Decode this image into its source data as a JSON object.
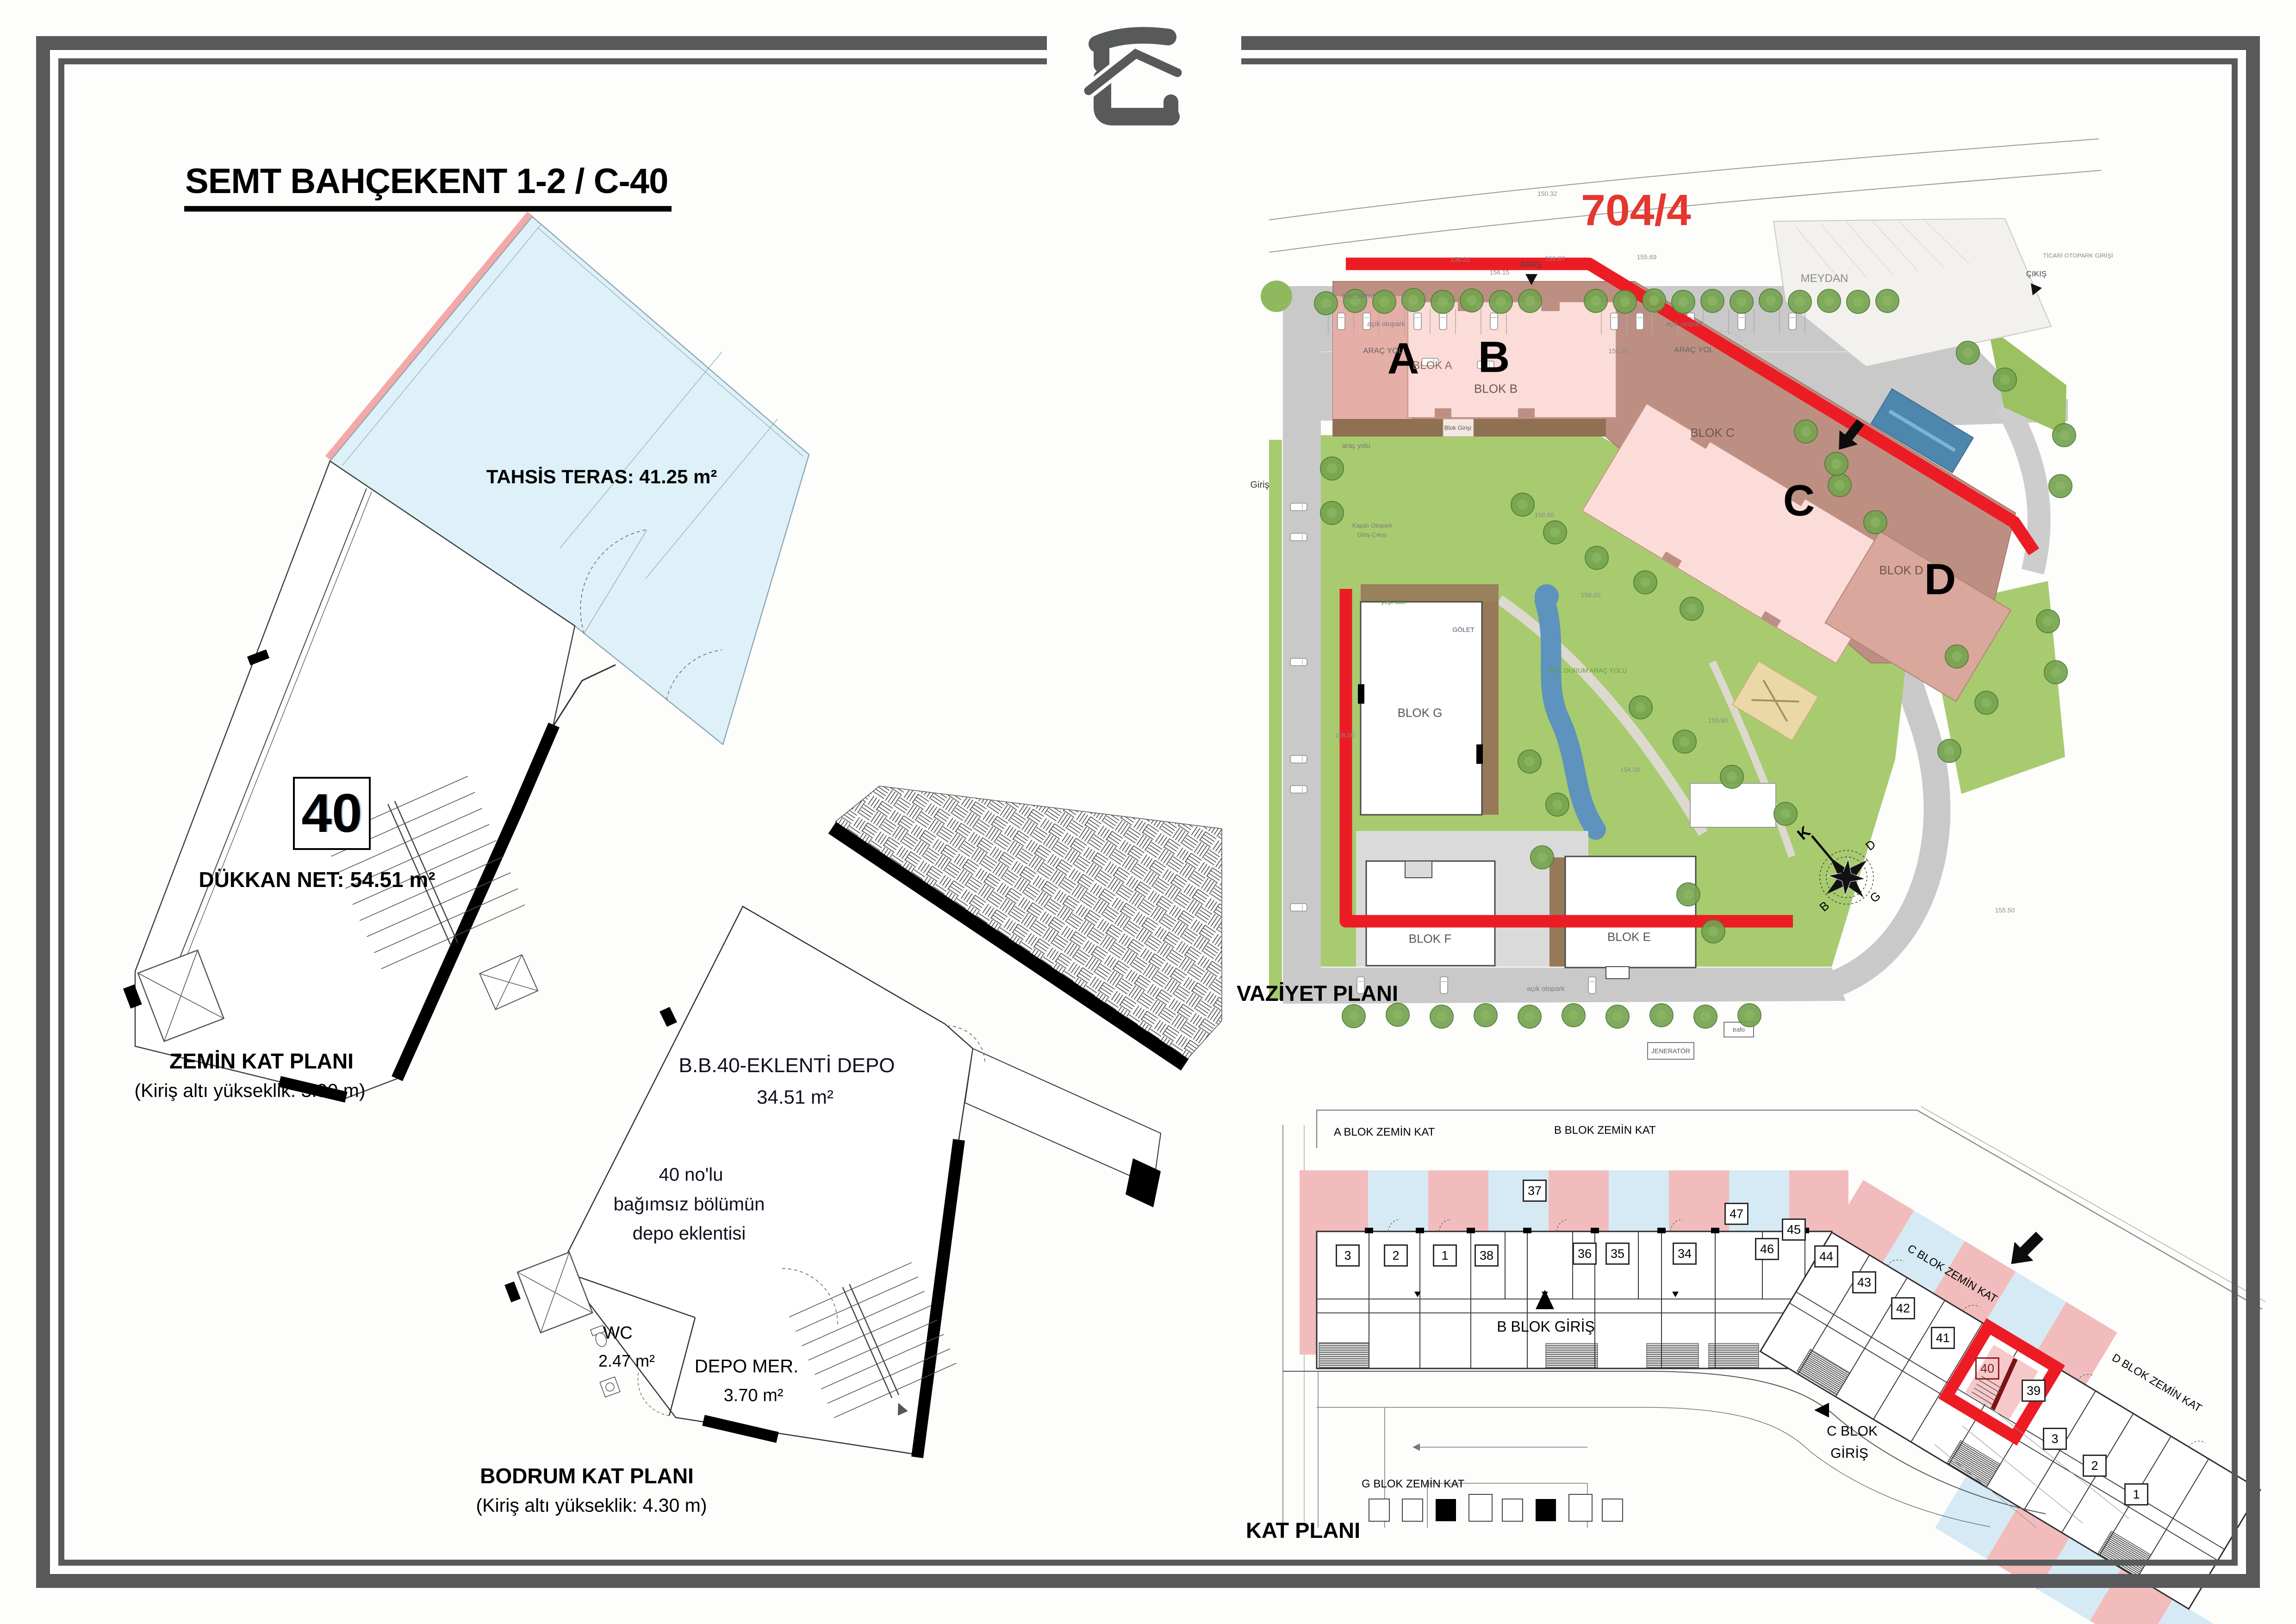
{
  "page": {
    "title": "SEMT BAHÇEKENT 1-2 / C-40"
  },
  "ground_floor_plan": {
    "terrace_label": "TAHSİS TERAS: 41.25 m²",
    "unit_number": "40",
    "shop_net_label": "DÜKKAN NET: 54.51 m²",
    "plan_name": "ZEMİN KAT PLANI",
    "height_note": "(Kiriş altı yükseklik: 3.90 m)"
  },
  "basement_plan": {
    "storage_name": "B.B.40-EKLENTİ DEPO",
    "storage_area": "34.51 m²",
    "annex_note_line1": "40 no'lu",
    "annex_note_line2": "bağımsız bölümün",
    "annex_note_line3": "depo eklentisi",
    "wc_label": "WC",
    "wc_area": "2.47 m²",
    "storage_stairs_label": "DEPO MER.",
    "storage_stairs_area": "3.70 m²",
    "plan_name": "BODRUM KAT PLANI",
    "height_note": "(Kiriş altı yükseklik: 4.30 m)"
  },
  "site_plan": {
    "plan_name": "VAZİYET PLANI",
    "parcel_number": "704/4",
    "block_letter_a": "A",
    "block_letter_b": "B",
    "block_letter_c": "C",
    "block_letter_d": "D",
    "blok_a": "BLOK A",
    "blok_b": "BLOK B",
    "blok_c": "BLOK C",
    "blok_d": "BLOK D",
    "blok_g": "BLOK G",
    "blok_f": "BLOK F",
    "blok_e": "BLOK E",
    "meydan": "MEYDAN",
    "kaldirim": "KALDIRIM",
    "acik_otopark": "açık otopark",
    "arac_yol": "ARAÇ YOL",
    "arac_yolu": "araç yolu",
    "giris": "GİRİŞ",
    "cikis": "ÇIKIŞ",
    "giris_small": "Giriş",
    "ticari_otopark": "TİCARİ OTOPARK GİRİŞİ",
    "blok_girisi": "Blok Girişi",
    "kapali_otopark_line1": "Kapalı Otopark",
    "kapali_otopark_line2": "Giriş-Çıkışı",
    "yesil_alan": "yeşil alan",
    "golet": "GÖLET",
    "acil_durum": "ACİL DURUM ARAÇ YOLU",
    "jenerator": "JENERATÖR",
    "trafo": "trafo",
    "compass": {
      "north": "K",
      "east": "D",
      "south": "G",
      "west": "B"
    },
    "elevations": [
      "150.32",
      "156.21",
      "156.15",
      "156.87",
      "155.69",
      "156.35",
      "156.00",
      "158.00",
      "158.80",
      "154.00",
      "155.80",
      "155.50"
    ]
  },
  "floor_plan": {
    "plan_name": "KAT PLANI",
    "a_blok": "A BLOK ZEMİN KAT",
    "b_blok": "B BLOK ZEMİN KAT",
    "c_blok": "C BLOK ZEMİN KAT",
    "d_blok": "D BLOK ZEMİN KAT",
    "g_blok": "G BLOK ZEMİN KAT",
    "b_giris": "B BLOK GİRİŞ",
    "c_giris_line1": "C BLOK",
    "c_giris_line2": "GİRİŞ",
    "row_units": [
      "3",
      "2",
      "1",
      "38",
      "37",
      "36",
      "35",
      "34",
      "47",
      "46"
    ],
    "diag_units": [
      "45",
      "44",
      "43",
      "42",
      "41",
      "39"
    ],
    "corner_units": [
      "3",
      "2",
      "1"
    ],
    "highlight_unit": "40"
  },
  "colors": {
    "frame": "#58595b",
    "terrace_fill": "#def1f8",
    "terrace_edge": "#f4a9a8",
    "red_accent": "#ec1c24",
    "parcel_red": "#e4372e",
    "strip_pink": "#f2bcbc",
    "strip_blue": "#d5eaf4",
    "site_building_pink": "#fbdcd8",
    "site_grass": "#a8cb70",
    "site_road": "#c9c9c9",
    "site_water": "#4e87ae"
  }
}
